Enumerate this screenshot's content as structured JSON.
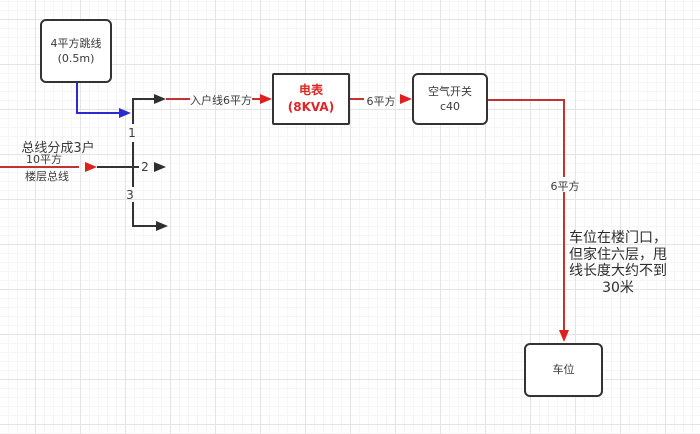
{
  "diagram": {
    "nodes": {
      "jumper": {
        "line1": "4平方跳线",
        "line2": "(0.5m)"
      },
      "meter": {
        "line1": "电表",
        "line2": "(8KVA)"
      },
      "breaker": {
        "line1": "空气开关",
        "line2": "c40"
      },
      "parking": {
        "line1": "车位"
      }
    },
    "wire_labels": {
      "entry": "入户线6平方",
      "meter_to_breaker": "6平方",
      "breaker_to_parking": "6平方"
    },
    "branch_numbers": {
      "b1": "1",
      "b2": "2",
      "b3": "3"
    },
    "left_annotation": {
      "title": "总线分成3户",
      "bus_line1": "10平方",
      "bus_line2": "楼层总线"
    },
    "note": {
      "line1": "车位在楼门口，",
      "line2": "但家住六层，甩",
      "line3": "线长度大约不到",
      "line4": "30米"
    },
    "colors": {
      "wire_red": "#c03434",
      "arrow_red": "#e02020",
      "wire_blue": "#2b2bd0",
      "wire_black": "#333333",
      "meter_text": "#e02525",
      "grid_major": "#e4e4e4",
      "grid_minor": "#f6f6f6"
    }
  }
}
